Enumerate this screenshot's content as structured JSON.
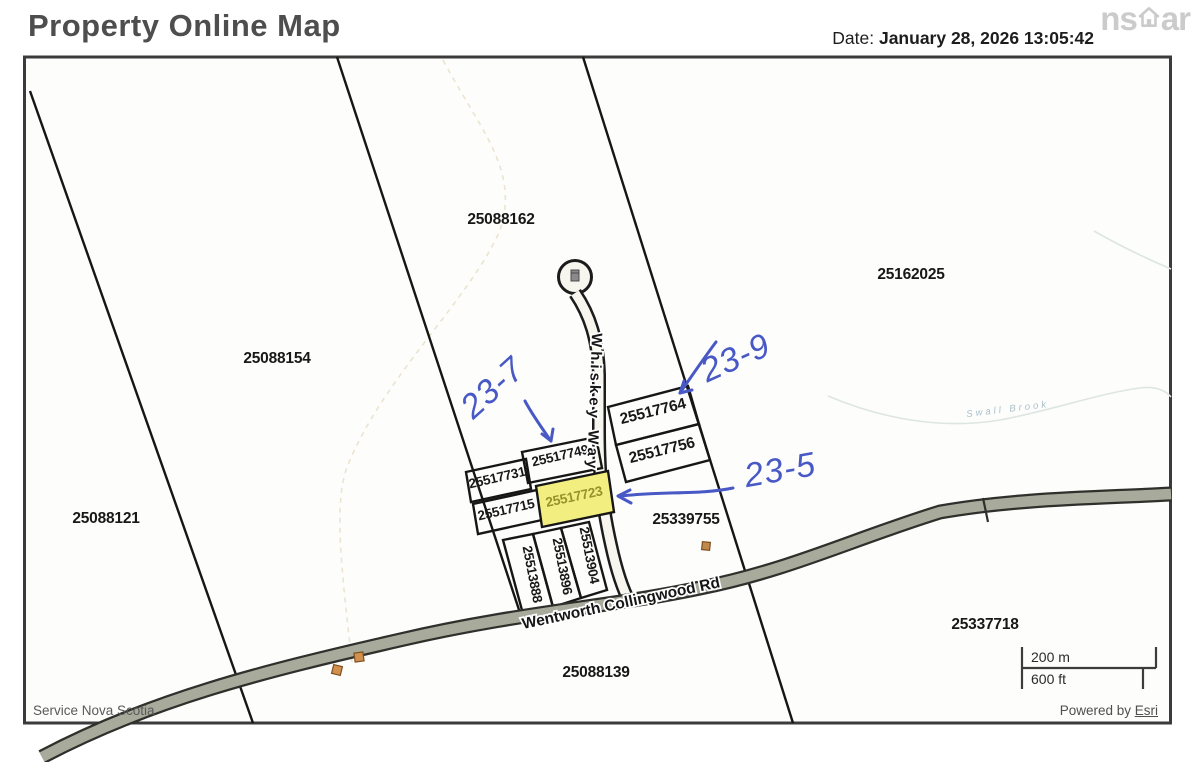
{
  "header": {
    "title": "Property Online Map",
    "date_label": "Date:",
    "date_value": "January 28, 2026 13:05:42",
    "logo_left": "ns",
    "logo_right": "ar"
  },
  "map": {
    "parcels": [
      {
        "id": "25088162"
      },
      {
        "id": "25162025"
      },
      {
        "id": "25088154"
      },
      {
        "id": "25088121"
      },
      {
        "id": "25517764"
      },
      {
        "id": "25517756"
      },
      {
        "id": "25517749"
      },
      {
        "id": "25517731"
      },
      {
        "id": "25517723",
        "highlighted": true
      },
      {
        "id": "25517715"
      },
      {
        "id": "25513888"
      },
      {
        "id": "25513896"
      },
      {
        "id": "25513904"
      },
      {
        "id": "25339755"
      },
      {
        "id": "25088139"
      },
      {
        "id": "25337718"
      }
    ],
    "roads": [
      {
        "name": "Whiskey Way"
      },
      {
        "name": "Wentworth Collingwood Rd"
      }
    ],
    "water": {
      "name": "Swall Brook"
    },
    "annotations": [
      {
        "text": "23-7",
        "target": "25517749"
      },
      {
        "text": "23-9",
        "target": "25517764"
      },
      {
        "text": "23-5",
        "target": "25517723"
      }
    ],
    "scale": {
      "metric": "200 m",
      "imperial": "600 ft"
    }
  },
  "footer": {
    "left": "Service Nova Scotia",
    "powered_by": "Powered by ",
    "esri_link": "Esri"
  },
  "colors": {
    "highlight_fill": "#f2ee80",
    "highlight_text": "#96922c",
    "ink_blue": "#4859c6",
    "road_fill": "#a8aa9b",
    "border": "#3b3b3b"
  }
}
